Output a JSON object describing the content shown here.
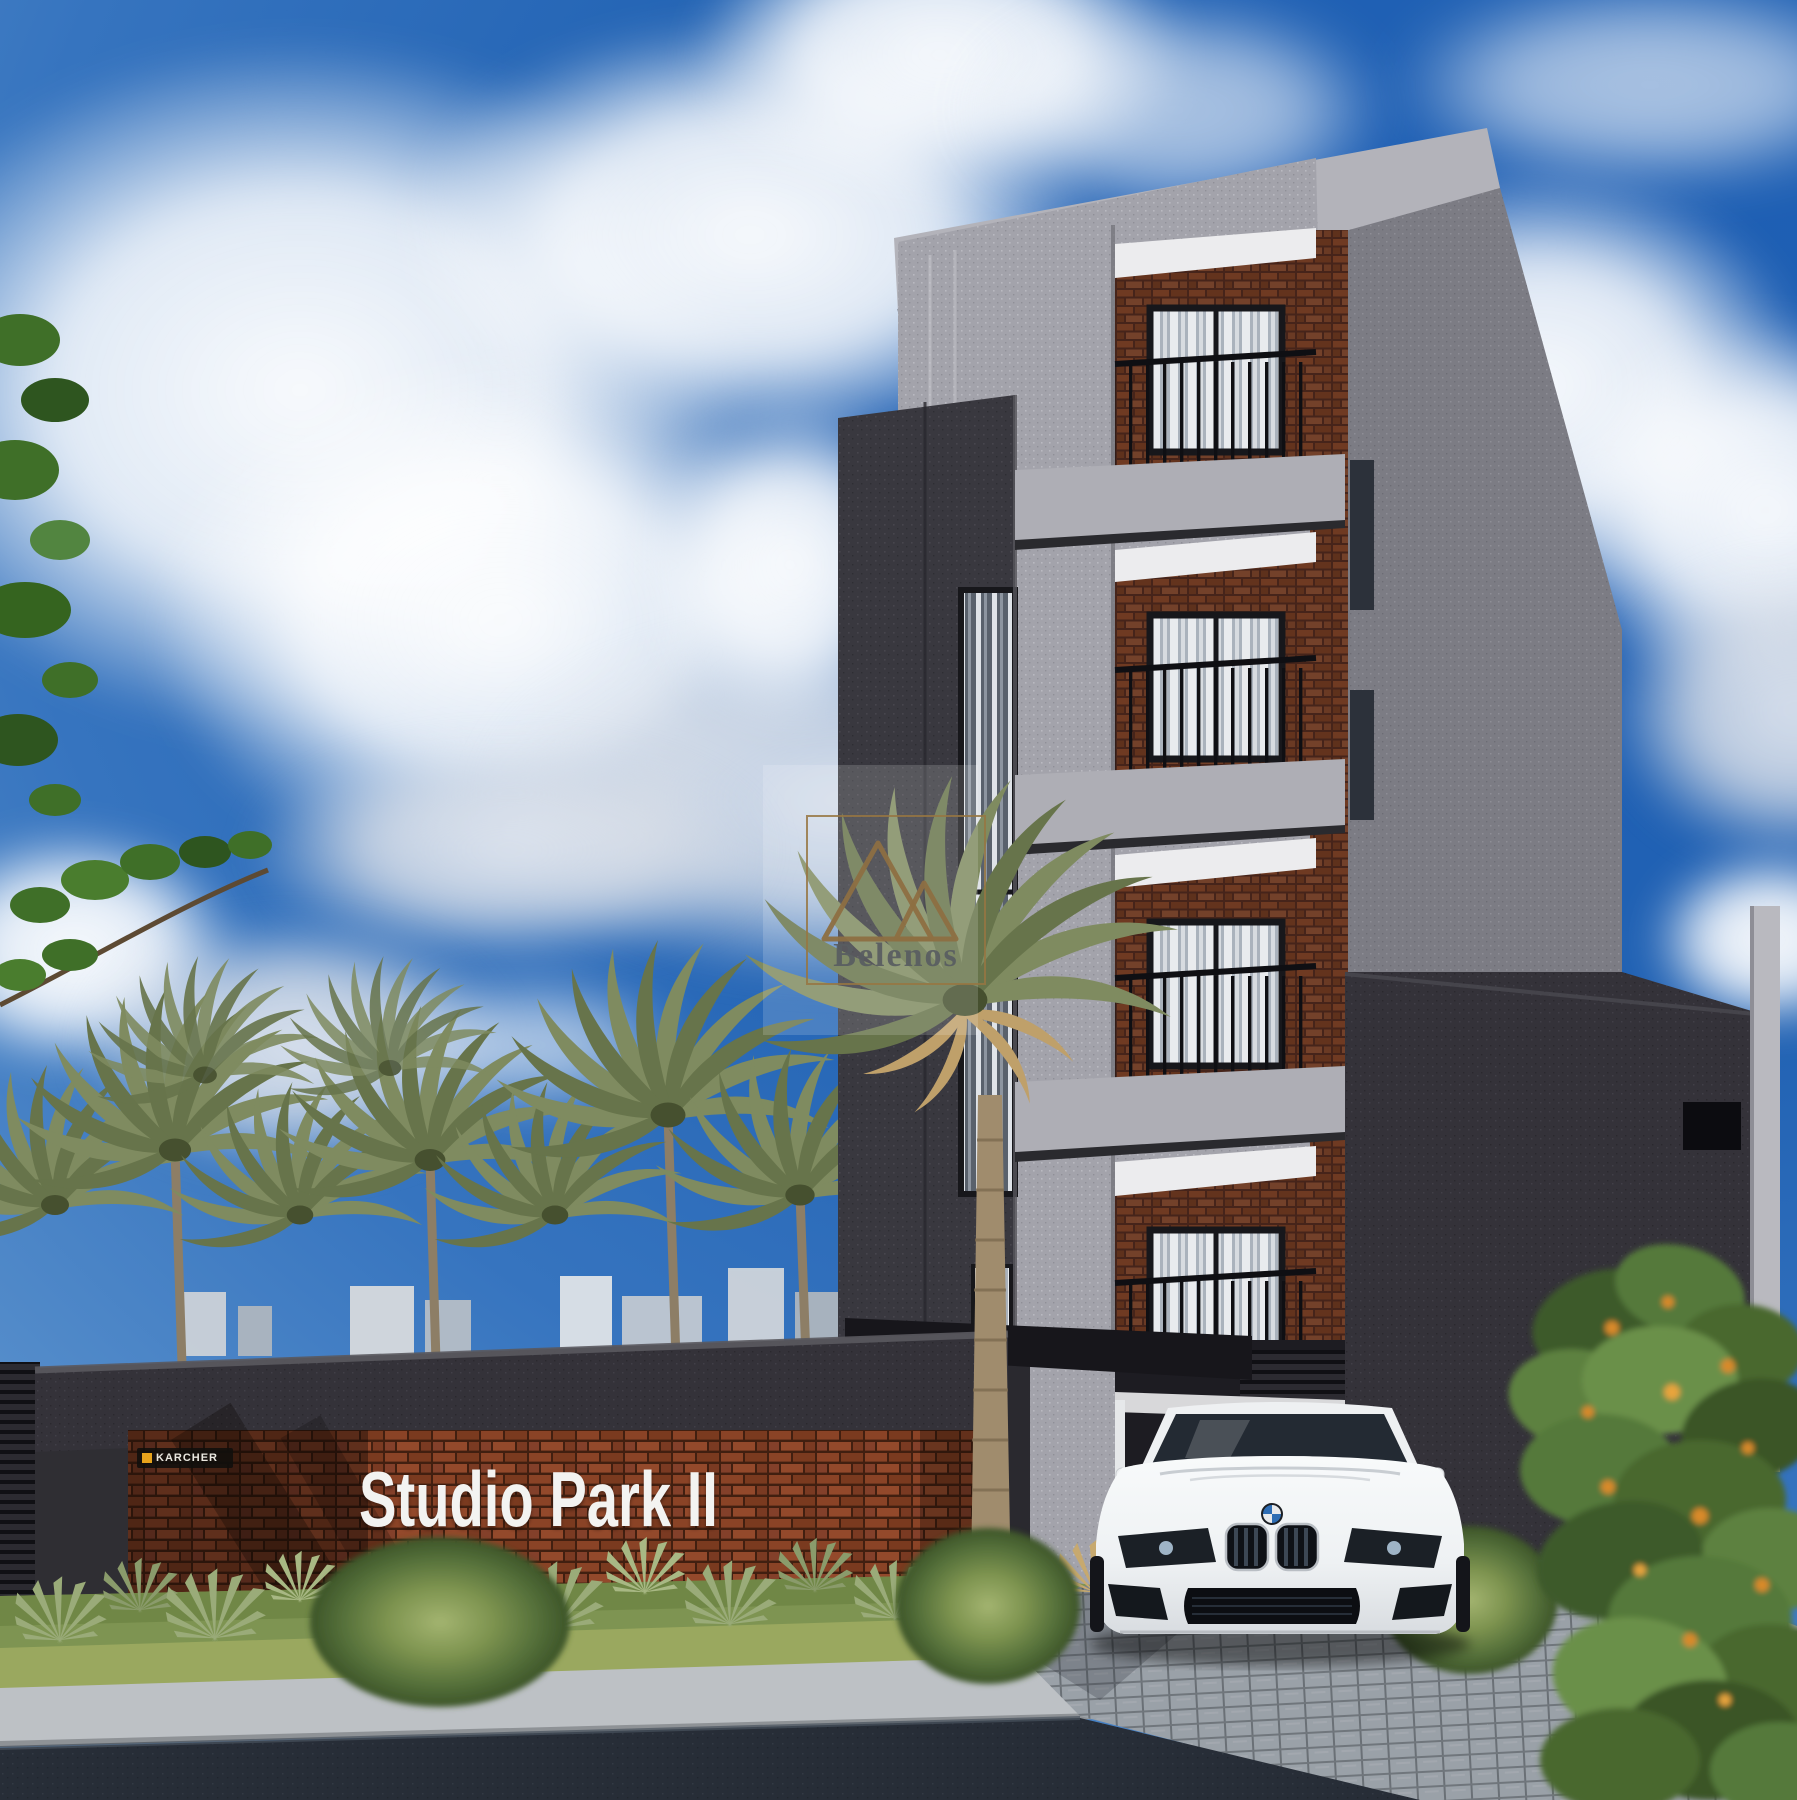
{
  "scene": {
    "description": "3D architectural rendering of a four-storey residential building with palm trees, perimeter brick sign wall and a white coupe parked at the entrance",
    "sign_wall": {
      "sign_text": "Studio Park II",
      "sign_text_color": "#f3f3f1",
      "badge_text": "KARCHER",
      "badge_accent_color": "#e7a31c",
      "brick_color": "#8a4326",
      "cap_color": "#343239"
    },
    "watermark": {
      "brand": "Belenos",
      "logo": "double-mountain-triangle",
      "frame_color": "#97744a",
      "text_color": "#585c61"
    },
    "building": {
      "floors_visible": 4,
      "facade_color": "#a3a3ab",
      "dark_tower_color": "#39383f",
      "balcony_brick_color": "#6f3a22",
      "railing_color": "#0f0f13",
      "side_wall_color": "#343239",
      "curtain_color": "#e9ebee"
    },
    "car": {
      "emblem": "BMW",
      "body_color": "#f2f4f6",
      "type": "white coupe, front view"
    },
    "landscape": {
      "palm_color": "#7f8b60",
      "lawn_color": "#7e9452",
      "agave_color": "#9aab79",
      "orange_flower_color": "#d98a2b",
      "asphalt_color": "#272d37",
      "paver_color": "#9aa1a8"
    },
    "sky": {
      "base_color": "#2263b4",
      "cloud_color": "#f4f6f8"
    }
  }
}
